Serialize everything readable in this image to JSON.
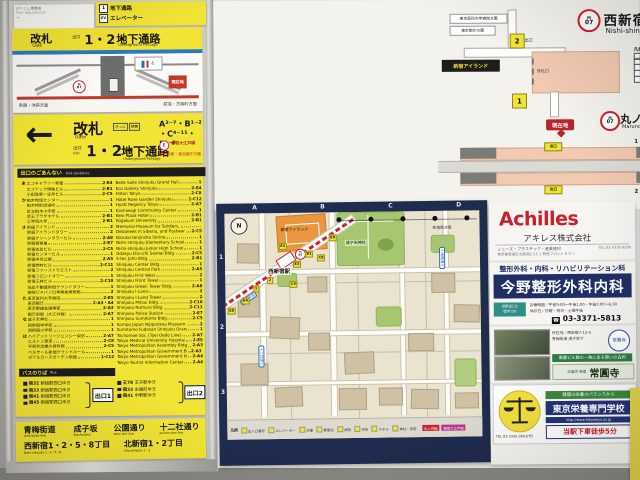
{
  "top_strip": {
    "notice": {
      "l1": "のりこし精算機",
      "l2": "Fare Adjustment",
      "l3": "→"
    },
    "passage": {
      "icon1": "1",
      "r1": "地下通路",
      "icon2": "EV",
      "r2": "エレベーター"
    }
  },
  "xsec": {
    "kaisatsu": "改札",
    "gate": "Gate",
    "deguchi": "出口",
    "nums": "1・2・",
    "chika": "地下通路",
    "chika_en": "Underground Passage",
    "m": "M",
    "no": "07",
    "here": "現在地",
    "left_dir": "新宿・池袋方面",
    "right_dir": "荻窪・方南町方面"
  },
  "arrow_sign": {
    "arrow": "←",
    "kaisatsu": "改札",
    "gate": "Gate",
    "tag1": "きっぷ",
    "tag2": "精算",
    "deguchi": "出口",
    "deguchi_en": "Exit",
    "nums": "1・2・",
    "chika": "地下通路",
    "chika_en": "Underground Passage",
    "exits_l1": "A²⁻⁷・B¹⁻²",
    "exits_l2": "・C⁴⁻¹¹・E¹⁻⁸",
    "oedo_mark": "E",
    "oedo1": "都営大江戸線",
    "oedo2": "都庁前駅・東京都庁方面"
  },
  "directory": {
    "title": "出口のごあんない",
    "title_en": "Exit Guidance",
    "jp": [
      {
        "g": "あ",
        "name": "エコギャラリー新宿",
        "code": "2-E4"
      },
      {
        "g": "",
        "name": "エステック情報ビル",
        "code": "2-B1"
      },
      {
        "g": "",
        "name": "小田急第一生命ビル",
        "code": "2-C5"
      },
      {
        "g": "か",
        "name": "柏木地域センター",
        "code": "1"
      },
      {
        "g": "",
        "name": "柏木特別出張所",
        "code": "1"
      },
      {
        "g": "",
        "name": "区立柏木小学校",
        "code": "1"
      },
      {
        "g": "",
        "name": "京王プラザホテル",
        "code": "2-B1"
      },
      {
        "g": "",
        "name": "工学院大学",
        "code": "2-B1"
      },
      {
        "g": "さ",
        "name": "新宿アイランド",
        "code": "2"
      },
      {
        "g": "",
        "name": "新宿アイランドタワー",
        "code": "2"
      },
      {
        "g": "",
        "name": "新宿グリーンタワービル",
        "code": "2-A8"
      },
      {
        "g": "",
        "name": "新宿警察署",
        "code": "2-E7"
      },
      {
        "g": "",
        "name": "新宿住友ビル",
        "code": "2-C5"
      },
      {
        "g": "",
        "name": "新宿センタービル",
        "code": "1"
      },
      {
        "g": "",
        "name": "新宿中央公園",
        "code": "2-A5"
      },
      {
        "g": "",
        "name": "新宿野村ビル",
        "code": "2-C11"
      },
      {
        "g": "",
        "name": "新宿ファーストウエスト",
        "code": "2"
      },
      {
        "g": "",
        "name": "新宿フロントタワー",
        "code": "1"
      },
      {
        "g": "",
        "name": "新宿三井ビル",
        "code": "2-C10"
      },
      {
        "g": "",
        "name": "住友不動産新宿グランドタワー",
        "code": "1"
      },
      {
        "g": "",
        "name": "損保ジャパン日本興亜美術館",
        "code": "2"
      },
      {
        "g": "た",
        "name": "東京医科大学病院",
        "code": "2-E5"
      },
      {
        "g": "",
        "name": "東京都庁",
        "code": "2-A3・A4"
      },
      {
        "g": "",
        "name": "東京都議会議事堂",
        "code": "2-A3"
      },
      {
        "g": "",
        "name": "都庁前駅（大江戸線）",
        "code": "2-A7"
      },
      {
        "g": "な",
        "name": "成子天神社",
        "code": "1"
      },
      {
        "g": "",
        "name": "西新宿中学校",
        "code": "1"
      },
      {
        "g": "",
        "name": "西新宿小学校",
        "code": "1"
      },
      {
        "g": "は",
        "name": "ハイアットリージェンシー東京",
        "code": "2-A7"
      },
      {
        "g": "",
        "name": "ヒルトン東京",
        "code": "2-C8"
      },
      {
        "g": "",
        "name": "平和祈念展示資料館",
        "code": "2-C5"
      },
      {
        "g": "",
        "name": "ベルサール新宿グランドホール",
        "code": "1"
      },
      {
        "g": "",
        "name": "ホテルローズガーデン新宿",
        "code": "1-C12"
      }
    ],
    "en": [
      {
        "name": "Belle Salle Shinjuku Grand Hall",
        "code": "1"
      },
      {
        "name": "Eco Gallery Shinjuku",
        "code": "2-E4"
      },
      {
        "name": "Hilton Tokyo",
        "code": "2-C8"
      },
      {
        "name": "Hotel Rose Garden Shinjuku",
        "code": "1-C12"
      },
      {
        "name": "Hyatt Regency Tokyo",
        "code": "2-A7"
      },
      {
        "name": "Kashiwagi Community Center",
        "code": "1"
      },
      {
        "name": "Keio Plaza Hotel",
        "code": "2-B1"
      },
      {
        "name": "Kogakuin University",
        "code": "2-B1"
      },
      {
        "name": "Memorial Museum for Soldiers,",
        "code": ""
      },
      {
        "name": "Detainees in Siberia, and Postwar Repatriates",
        "code": "2-C5"
      },
      {
        "name": "Naruko-tenjinsha Shrine",
        "code": "1"
      },
      {
        "name": "Nishi-shinjuku Elementary School",
        "code": "1"
      },
      {
        "name": "Nishi-shinjuku Junior High School",
        "code": "1"
      },
      {
        "name": "Odakyu Dai-ichi Seimei Bldg.",
        "code": "2-C5"
      },
      {
        "name": "S-tec Joho Bldg.",
        "code": "2-B1"
      },
      {
        "name": "Shinjuku Center Bldg.",
        "code": "1"
      },
      {
        "name": "Shinjuku Central Park",
        "code": "2-A5"
      },
      {
        "name": "Shinjuku First West",
        "code": "2"
      },
      {
        "name": "Shinjuku Front Tower",
        "code": "1"
      },
      {
        "name": "Shinjuku Green Tower Bldg.",
        "code": "2-A8"
      },
      {
        "name": "Shinjuku I-Land",
        "code": "2"
      },
      {
        "name": "Shinjuku I-Land Tower",
        "code": "2"
      },
      {
        "name": "Shinjuku Mitsui Bldg.",
        "code": "2-C10"
      },
      {
        "name": "Shinjuku Nomura Bldg.",
        "code": "2-C11"
      },
      {
        "name": "Shinjuku Police Station",
        "code": "2-E7"
      },
      {
        "name": "Shinjuku Sumitomo Bldg.",
        "code": "2-C5"
      },
      {
        "name": "Sompo Japan Nipponkoa Museum of Art",
        "code": "2"
      },
      {
        "name": "Sumitomo Fudosan Shinjuku Grand Tower",
        "code": "1"
      },
      {
        "name": "Tochomae Sta. (Toei Oedo Line)",
        "code": "2-A7"
      },
      {
        "name": "Tokyo Medical University Hospital",
        "code": "2-E5"
      },
      {
        "name": "Tokyo Metropolitan Assembly Bldg.",
        "code": "2-A3"
      },
      {
        "name": "Tokyo Metropolitan Government Bldg.",
        "code": "2-A3・A4"
      },
      {
        "name": "Tokyo Metropolitan Government No.1 Bldg.",
        "code": "2-A4"
      },
      {
        "name": "Tokyo Tourist Information Center",
        "code": "2-A4"
      }
    ]
  },
  "bus": {
    "title": "バスのりば",
    "title_en": "Bus",
    "groups": [
      {
        "exit": "出口1",
        "routes": [
          {
            "no": "宿32",
            "dest": "新宿駅西口ゆき"
          },
          {
            "no": "宿33",
            "dest": "新宿駅西口ゆき"
          },
          {
            "no": "宿41",
            "dest": "新宿駅西口ゆき"
          },
          {
            "no": "宿45",
            "dest": "新宿駅西口ゆき"
          }
        ]
      },
      {
        "exit": "出口2",
        "routes": [
          {
            "no": "王78",
            "dest": "王子駅ゆき"
          },
          {
            "no": "宿33",
            "dest": "永福町ゆき"
          },
          {
            "no": "宿41",
            "dest": "中野駅ゆき"
          }
        ]
      }
    ]
  },
  "street_sign": {
    "roads": [
      {
        "jp": "青梅街道",
        "en": "Ome-kaido Ave."
      },
      {
        "jp": "成子坂",
        "en": "Narukozaka"
      },
      {
        "jp": "公園通り",
        "en": "Koen-dori Ave."
      },
      {
        "jp": "十二社通り",
        "en": "Junisha-dori Ave."
      }
    ],
    "areas": [
      {
        "jp": "西新宿1・2・5・8丁目",
        "en": "Nishi-shinjuku 1・2・5・8"
      },
      {
        "jp": "北新宿1・2丁目",
        "en": "Kita-shinjuku 1・2"
      }
    ]
  },
  "guide": {
    "m": "M",
    "no": "07",
    "title": "西新宿駅構内案内",
    "title_en": "Nishi-shinjuku Sta. Guide",
    "north": "↘",
    "legend_title": "凡例",
    "legend_en": "Legend",
    "legend": [
      "改札口",
      "エレベーター",
      "エスカレーター",
      "階段",
      "きっぷうりば",
      "トイレ",
      "だれでもトイレ",
      "コインロッカー",
      "AED",
      "交番"
    ],
    "box_hospital": "東京医科大学病院方面",
    "box_tocho": "東京都庁方面",
    "island": "新宿アイランド",
    "exit_word": "出口",
    "exit1": "1",
    "exit2": "2",
    "kaisatsu": "改札口",
    "line": "丸ノ内線",
    "line_en": "Marunouchi Line",
    "here": "現在地",
    "plat1_no": "1",
    "plat1": "荻窪方面",
    "plat2_no": "2",
    "plat2": "池袋方面",
    "bf1": "現在地から地上までの",
    "bf2": "バリアフリー移動ルート"
  },
  "fire": {
    "title": "火災時の対応",
    "p1": "　東京地下鉄株式会社では、トンネル内を走行中に万一列車火災が発生した場合には、次駅まで走行し避難することを原則としております。やむを得ずトンネル内で停止した場合は、係員の指示により列車の前後から安全に避難することができます。列車内で火災を発見した場合には、非常通報器により乗務員に通報してください。",
    "p2": "　駅構内でも万一の火災発生に備え、自動火災報知設備をはじめ、非常警報設備、消火設備、排煙設備等を整備しております。これらの設備は、駅事務室内の防災管理室で集中管理され、駅構内を総合的に監視しています。また、火災が発生した場合でも、お客様の避難誘導や消火活動などが迅速・的確に行える体制をとっていますので、万一の際、係員の指示があった場合にはその指示に従ってください。",
    "sub": "車両搭載装置",
    "dir": "進行方向",
    "hi": "非",
    "sho": "消",
    "leg_hi": "非常通報器の位置を表示",
    "leg_sho": "消火器の位置を表示"
  },
  "map": {
    "grid": [
      "A",
      "B",
      "C",
      "D"
    ],
    "rows": [
      "1",
      "2",
      "3"
    ],
    "compass": "N",
    "station": "西新宿駅",
    "to_shinjuku": "新宿駅方面",
    "shrine": "成子天神社",
    "island": "新宿アイランド",
    "road1": "青梅街道",
    "road2": "十二社通り",
    "road3": "小滝橋通り",
    "tags": [
      "E5",
      "E4",
      "1",
      "2",
      "E1",
      "E2",
      "B1",
      "C5",
      "C8",
      "E8"
    ],
    "legend_title": "凡例",
    "legend": [
      "出入口番号",
      "エレベーター",
      "交番",
      "郵便局",
      "病院",
      "学校",
      "ホテル",
      "神社・寺院"
    ],
    "line_tag": "丸ノ内線",
    "line_tag2": "都営大江戸線"
  },
  "ads": {
    "achilles": {
      "logo": "Achilles",
      "company": "アキレス株式会社",
      "desc": "シューズ・プラスチック・産業資材",
      "addr": "東京都新宿区北新宿2-21-1 新宿フロントタワー",
      "tel": "TEL.03-5338-9200"
    },
    "konno": {
      "spec": "整形外科・内科・リハビリテーション科",
      "name": "今野整形外科内科",
      "hours": "診療時間／午前9:00〜午後1:00・午後3:00〜6:30",
      "closed": "休診日／日曜・祝日・土曜午後",
      "tel": "03-3371-5813",
      "tag1": "当駅出口1",
      "tag2": "徒歩3分"
    },
    "temple": {
      "addr": "所在地／西新宿7-12-5",
      "access": "青梅街道 成子坂下",
      "catch": "高層ビル群の一角にある憩いの古刹",
      "sect": "日蓮宗 新宿",
      "name": "常圓寺"
    },
    "eiyo": {
      "catch": "健康は栄養のバランスから",
      "name": "東京栄養専門学校",
      "url": "http://www.tokyoeiyo.ac.jp",
      "walk": "当駅下車徒歩5分",
      "tel": "TEL.03-3342-3661(代)"
    }
  }
}
